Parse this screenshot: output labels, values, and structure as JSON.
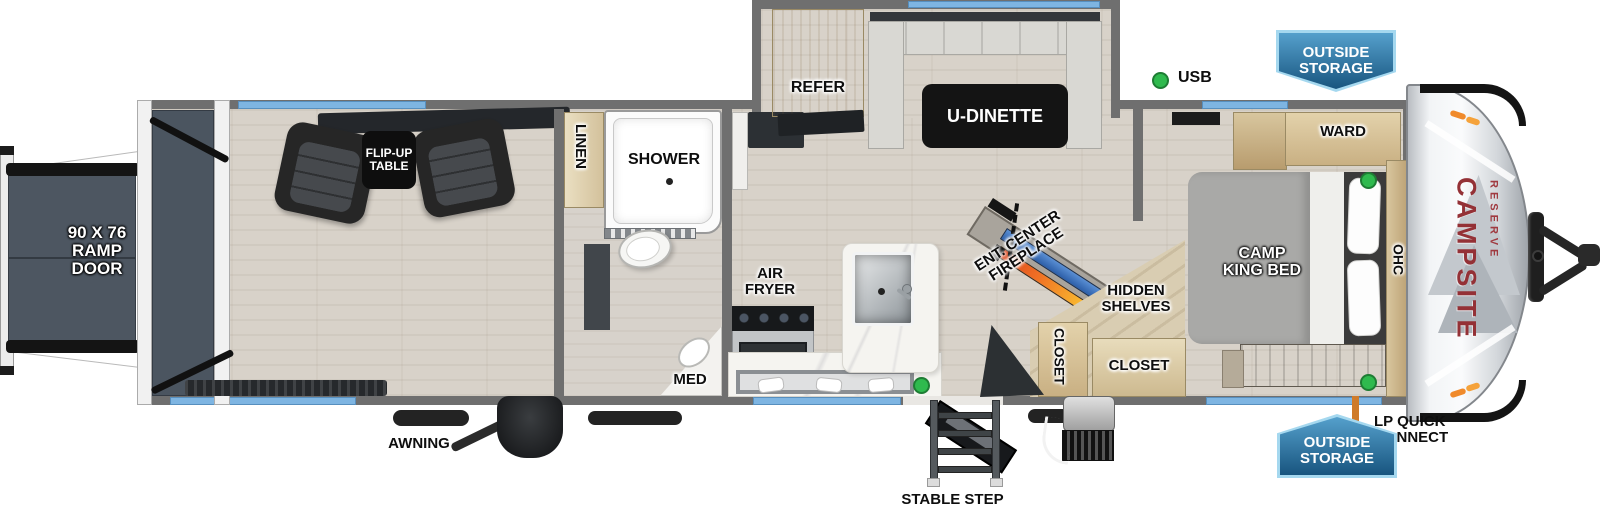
{
  "labels": {
    "ramp_door": [
      "90 X 76",
      "RAMP",
      "DOOR"
    ],
    "flip_table": [
      "FLIP-UP",
      "TABLE"
    ],
    "linen": "LINEN",
    "shower": "SHOWER",
    "med": "MED",
    "air_fryer": [
      "AIR",
      "FRYER"
    ],
    "refer": "REFER",
    "u_dinette": "U-DINETTE",
    "ent_center": [
      "ENT. CENTER",
      "FIREPLACE"
    ],
    "hidden_shelves": [
      "HIDDEN",
      "SHELVES"
    ],
    "closet_front": "CLOSET",
    "closet_bedroom": "CLOSET",
    "ward": "WARD",
    "camp_king_bed": [
      "CAMP",
      "KING BED"
    ],
    "ohc": "OHC"
  },
  "legend": {
    "usb": "USB"
  },
  "exterior": {
    "awning": "AWNING",
    "stable_step": "STABLE STEP",
    "lp_quick_connect": [
      "LP QUICK",
      "CONNECT"
    ],
    "outside_storage": [
      "OUTSIDE",
      "STORAGE"
    ]
  },
  "brand": {
    "name": "CAMPSITE",
    "series": "RESERVE"
  },
  "colors": {
    "wall": "#6f6f6f",
    "window_blue": "#7eb5e2",
    "badge_blue_dark": "#18557f",
    "badge_blue_light": "#a5d8ef",
    "usb_green": "#2fba4e",
    "brand_red": "#943136",
    "lp_orange": "#e0832f",
    "fireplace_orange": "#f59d2c",
    "tv_blue": "#3d6fb4"
  }
}
